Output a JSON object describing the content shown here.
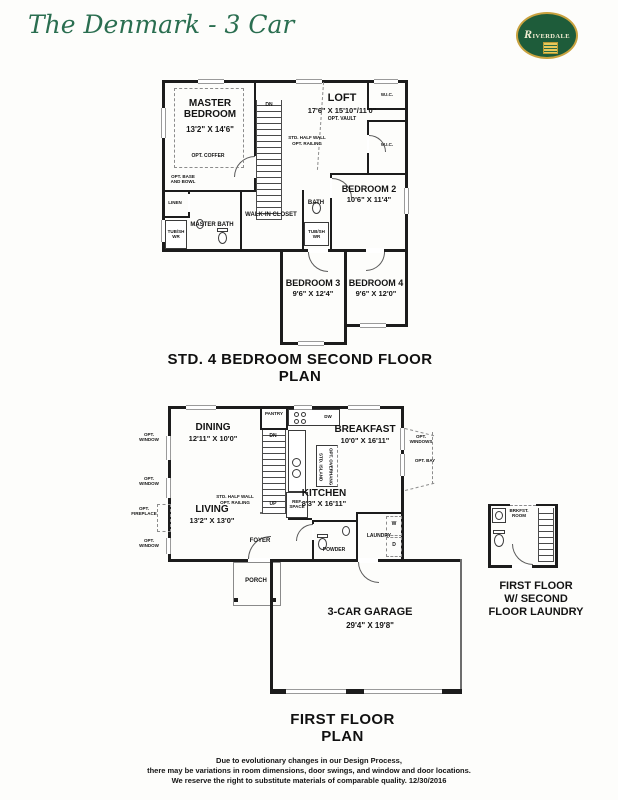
{
  "header": {
    "title": "The Denmark - 3 Car",
    "logo_text": "RIVERDALE"
  },
  "second_floor": {
    "caption": "STD. 4 BEDROOM SECOND FLOOR PLAN",
    "master_bedroom": {
      "name": "MASTER BEDROOM",
      "dims": "13'2\" X 14'6\"",
      "opt_coffer": "OPT. COFFER",
      "opt_base": "OPT. BASE AND BOWL"
    },
    "loft": {
      "name": "LOFT",
      "dims": "17'6\" X 15'10\"/11'0\"",
      "opt": "OPT. VAULT"
    },
    "stairs": {
      "dn": "DN",
      "half_wall": "STD. HALF WALL",
      "railing": "OPT. RAILING"
    },
    "bedroom2": {
      "name": "BEDROOM 2",
      "dims": "10'6\" X 11'4\""
    },
    "bedroom3": {
      "name": "BEDROOM 3",
      "dims": "9'6\" X 12'4\""
    },
    "bedroom4": {
      "name": "BEDROOM 4",
      "dims": "9'6\" X 12'0\""
    },
    "wic": "W.I.C.",
    "linen": "LINEN",
    "master_bath": {
      "name": "MASTER BATH",
      "tub": "TUB/SHWR"
    },
    "walk_in_closet": "WALK-IN CLOSET",
    "bath": {
      "name": "BATH",
      "tub": "TUB/SHWR"
    }
  },
  "first_floor": {
    "caption": "FIRST FLOOR PLAN",
    "dining": {
      "name": "DINING",
      "dims": "12'11\" X 10'0\""
    },
    "breakfast": {
      "name": "BREAKFAST",
      "dims": "10'0\" X 16'11\""
    },
    "kitchen": {
      "name": "KITCHEN",
      "dims": "8'3\" X 16'11\"",
      "pantry": "PANTRY",
      "dw": "DW",
      "island_std": "STD. ISLAND",
      "island_opt": "OPT. OVERHANG",
      "ref": "REF. SPACE"
    },
    "living": {
      "name": "LIVING",
      "dims": "13'2\" X 13'0\""
    },
    "stairs": {
      "dn": "DN",
      "up": "UP",
      "half_wall": "STD. HALF WALL",
      "railing": "OPT. RAILING"
    },
    "foyer": "FOYER",
    "porch": "PORCH",
    "powder": "POWDER",
    "laundry": {
      "name": "LAUNDRY",
      "washer": "W",
      "dryer": "D"
    },
    "garage": {
      "name": "3-CAR GARAGE",
      "dims": "29'4\" X 19'8\""
    },
    "opt_window": "OPT. WINDOW",
    "opt_windows": "OPT. WINDOWS",
    "opt_bay": "OPT. BAY",
    "opt_fireplace": "OPT. FIREPLACE"
  },
  "detail": {
    "brkfst_room": "BRKFST. ROOM",
    "caption_l1": "FIRST FLOOR",
    "caption_l2": "W/ SECOND",
    "caption_l3": "FLOOR LAUNDRY"
  },
  "footer": {
    "line1": "Due to evolutionary changes in our Design Process,",
    "line2": "there may be variations in room dimensions, door swings, and window and door locations.",
    "line3": "We reserve the right to substitute materials of comparable quality. 12/30/2016"
  },
  "colors": {
    "brand_green": "#1e5c3a",
    "title_green": "#2a6e50",
    "gold": "#c9a23f",
    "wall": "#1c1c1c"
  }
}
